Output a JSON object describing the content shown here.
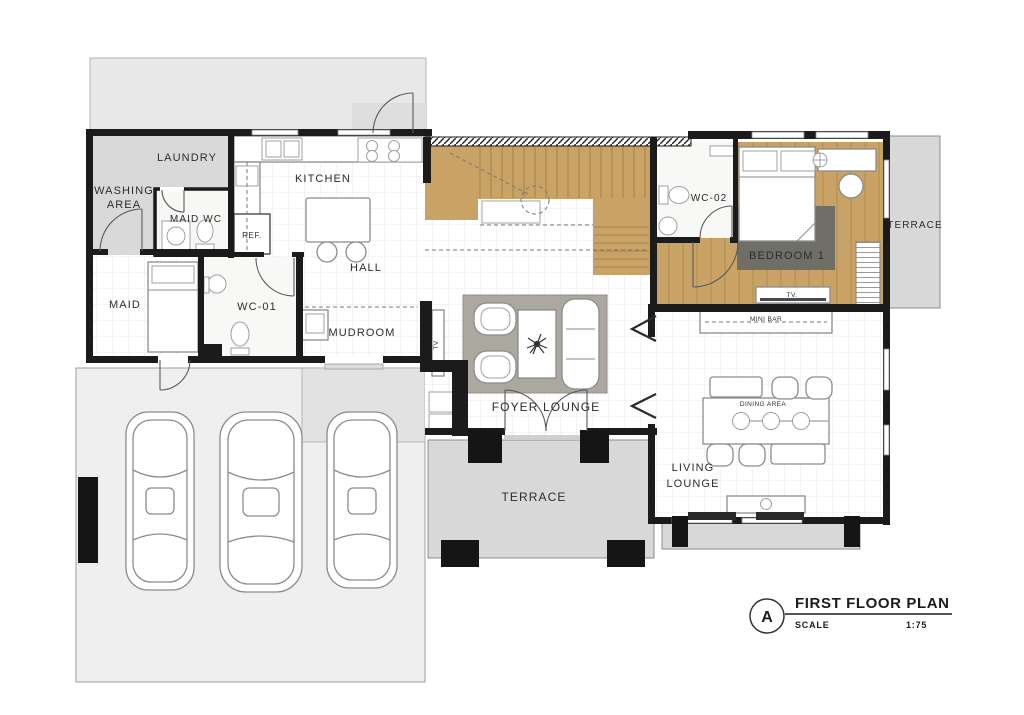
{
  "plan": {
    "labels": {
      "laundry": "LAUNDRY",
      "washing_line1": "WASHING",
      "washing_line2": "AREA",
      "maid_wc": "MAID WC",
      "kitchen": "KITCHEN",
      "ref": "REF.",
      "hall": "HALL",
      "maid": "MAID",
      "wc01": "WC-01",
      "mudroom": "MUDROOM",
      "foyer_lounge": "FOYER LOUNGE",
      "terrace_bottom": "TERRACE",
      "terrace_right": "TERRACE",
      "wc02": "WC-02",
      "bedroom1": "BEDROOM 1",
      "mini_bar": "MINI BAR",
      "dining_area": "DINING AREA",
      "living_line1": "LIVING",
      "living_line2": "LOUNGE",
      "tv_foyer": "TV",
      "tv_bedroom": "TV."
    },
    "title_block": {
      "marker": "A",
      "title": "FIRST FLOOR PLAN",
      "scale_label": "SCALE",
      "scale_value": "1:75"
    },
    "colors": {
      "wall": "#1b1b1b",
      "wood": "#c9a266",
      "yard": "#e8e8e8",
      "garage": "#efefef",
      "terrace": "#d8d8d8",
      "rug_light": "#aba99f",
      "rug_dark": "#6f6f68",
      "text": "#2c2c2c"
    }
  }
}
